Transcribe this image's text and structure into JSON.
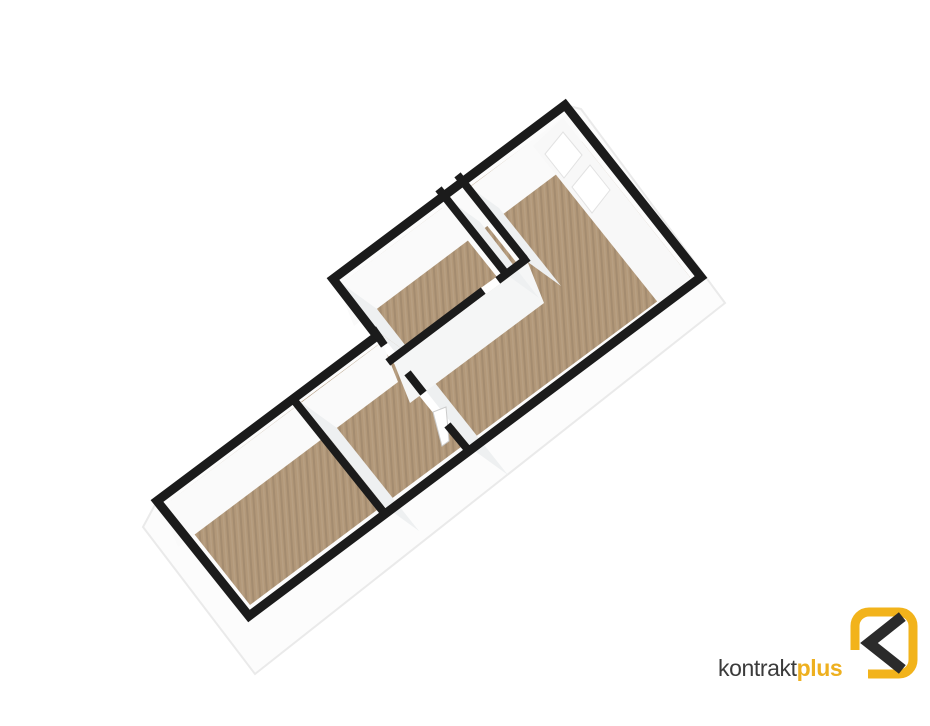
{
  "canvas": {
    "width": 930,
    "height": 726,
    "background": "#ffffff"
  },
  "palette": {
    "wall_line": "#1b1b1b",
    "skirt_fill": "#fcfcfc",
    "skirt_edge": "#eaeaea",
    "face_bright": "#fafafa",
    "face_side": "#eef0f1",
    "face_strip": "#f5f6f6",
    "face_east": "#f8f8f8",
    "white": "#ffffff"
  },
  "floor_pattern": {
    "base": "#b29879",
    "dark": "rgba(0,0,0,0.08)",
    "light": "rgba(255,255,255,0.07)",
    "tile": 7,
    "angle": -4
  },
  "scene": {
    "layers": [
      {
        "name": "slab-silhouette",
        "type": "polygon",
        "points": [
          [
            581,
            109
          ],
          [
            725,
            303
          ],
          [
            255,
            674
          ],
          [
            143,
            527
          ],
          [
            157,
            501
          ],
          [
            377,
            336
          ],
          [
            333,
            279
          ],
          [
            565,
            105
          ]
        ],
        "fill": "#fcfcfc",
        "stroke": "#eaeaea",
        "width": 2
      },
      {
        "name": "floor-bedroom-1",
        "type": "polygon",
        "points": [
          [
            250,
            605
          ],
          [
            377,
            510
          ],
          [
            295,
            407
          ],
          [
            169,
            502
          ]
        ],
        "fill": "planks"
      },
      {
        "name": "floor-bedroom-2",
        "type": "polygon",
        "points": [
          [
            383,
            505
          ],
          [
            461,
            447
          ],
          [
            379,
            344
          ],
          [
            301,
            402
          ]
        ],
        "fill": "planks"
      },
      {
        "name": "floor-kitchen",
        "type": "polygon",
        "points": [
          [
            395,
            353
          ],
          [
            497,
            277
          ],
          [
            442,
            208
          ],
          [
            341,
            284
          ]
        ],
        "fill": "planks"
      },
      {
        "name": "floor-hallway",
        "type": "polygon",
        "points": [
          [
            503,
            272
          ],
          [
            516,
            262
          ],
          [
            462,
            194
          ],
          [
            449,
            204
          ]
        ],
        "fill": "planks"
      },
      {
        "name": "floor-living-room",
        "type": "polygon",
        "points": [
          [
            467,
            443
          ],
          [
            690,
            277
          ],
          [
            563,
            118
          ],
          [
            468,
            188
          ],
          [
            528,
            263
          ],
          [
            400,
            359
          ]
        ],
        "fill": "planks"
      },
      {
        "name": "door-threshold-1",
        "type": "polygon",
        "points": [
          [
            447,
            430
          ],
          [
            454,
            425
          ],
          [
            424,
            388
          ],
          [
            417,
            393
          ]
        ],
        "fill": "#ffffff"
      },
      {
        "name": "door-threshold-2",
        "type": "polygon",
        "points": [
          [
            406,
            379
          ],
          [
            413,
            374
          ],
          [
            385,
            339
          ],
          [
            379,
            344
          ]
        ],
        "fill": "#ffffff"
      },
      {
        "name": "door-threshold-3",
        "type": "polygon",
        "points": [
          [
            483,
            296
          ],
          [
            504,
            281
          ],
          [
            499,
            275
          ],
          [
            478,
            290
          ]
        ],
        "fill": "#ffffff"
      },
      {
        "name": "face-bedrooms-north-wall",
        "type": "polygon",
        "points": [
          [
            162,
            507
          ],
          [
            382,
            342
          ],
          [
            398,
            382
          ],
          [
            178,
            547
          ]
        ],
        "fill": "#fafafa"
      },
      {
        "name": "face-living-north-wall",
        "type": "polygon",
        "points": [
          [
            338,
            286
          ],
          [
            570,
            112
          ],
          [
            586,
            152
          ],
          [
            354,
            326
          ]
        ],
        "fill": "#fafafa"
      },
      {
        "name": "face-kitchen-west-wall",
        "type": "polygon",
        "points": [
          [
            341,
            283
          ],
          [
            380,
            333
          ],
          [
            416,
            359
          ],
          [
            377,
            309
          ]
        ],
        "fill": "#eef0f1"
      },
      {
        "name": "face-bedroom-divider-wall",
        "type": "polygon",
        "points": [
          [
            301,
            402
          ],
          [
            383,
            505
          ],
          [
            419,
            531
          ],
          [
            337,
            428
          ]
        ],
        "fill": "#eef0f1"
      },
      {
        "name": "face-partition-east-wall",
        "type": "polygon",
        "points": [
          [
            380,
            333
          ],
          [
            472,
            449
          ],
          [
            508,
            475
          ],
          [
            416,
            359
          ]
        ],
        "fill": "#eef0f1"
      },
      {
        "name": "face-strip-north-wall",
        "type": "polygon",
        "points": [
          [
            394,
            363
          ],
          [
            528,
            263
          ],
          [
            544,
            303
          ],
          [
            410,
            403
          ]
        ],
        "fill": "#f5f6f6"
      },
      {
        "name": "face-hallway-west-wall",
        "type": "polygon",
        "points": [
          [
            444,
            196
          ],
          [
            503,
            272
          ],
          [
            539,
            298
          ],
          [
            480,
            222
          ]
        ],
        "fill": "#eef0f1"
      },
      {
        "name": "face-hallway-east-wall",
        "type": "polygon",
        "points": [
          [
            463,
            182
          ],
          [
            525,
            260
          ],
          [
            561,
            286
          ],
          [
            499,
            208
          ]
        ],
        "fill": "#eef0f1"
      },
      {
        "name": "face-east-wall",
        "type": "polygon",
        "points": [
          [
            690,
            277
          ],
          [
            563,
            118
          ],
          [
            533,
            146
          ],
          [
            660,
            305
          ]
        ],
        "fill": "#f8f8f8"
      },
      {
        "name": "window-1",
        "type": "polygon",
        "points": [
          [
            610,
            190
          ],
          [
            590,
            165
          ],
          [
            572,
            187
          ],
          [
            592,
            213
          ]
        ],
        "fill": "#ffffff",
        "stroke": "#e2e2e2",
        "width": 1
      },
      {
        "name": "window-2",
        "type": "polygon",
        "points": [
          [
            582,
            155
          ],
          [
            563,
            132
          ],
          [
            545,
            154
          ],
          [
            564,
            178
          ]
        ],
        "fill": "#ffffff",
        "stroke": "#e2e2e2",
        "width": 1
      },
      {
        "name": "door-leaf",
        "type": "polygon",
        "points": [
          [
            446,
            407
          ],
          [
            433,
            412
          ],
          [
            442,
            446
          ],
          [
            449,
            441
          ]
        ],
        "fill": "#ffffff",
        "stroke": "#cccccc",
        "width": 1
      },
      {
        "name": "wall-top-outer-outline",
        "type": "polygon",
        "points": [
          [
            249,
            616
          ],
          [
            701,
            277
          ],
          [
            565,
            105
          ],
          [
            333,
            279
          ],
          [
            377,
            336
          ],
          [
            157,
            501
          ]
        ],
        "fill": "none",
        "stroke": "#1b1b1b",
        "width": 9
      },
      {
        "name": "wall-top-bedroom-divider",
        "type": "polyline",
        "points": [
          [
            385,
            514
          ],
          [
            293,
            399
          ]
        ],
        "stroke": "#1b1b1b",
        "width": 8
      },
      {
        "name": "wall-top-partition-a",
        "type": "polyline",
        "points": [
          [
            469,
            451
          ],
          [
            450,
            428
          ]
        ],
        "stroke": "#1b1b1b",
        "width": 8
      },
      {
        "name": "wall-top-partition-b",
        "type": "polyline",
        "points": [
          [
            421,
            390
          ],
          [
            410,
            376
          ]
        ],
        "stroke": "#1b1b1b",
        "width": 8
      },
      {
        "name": "wall-top-partition-c",
        "type": "polyline",
        "points": [
          [
            382,
            342
          ],
          [
            375,
            332
          ]
        ],
        "stroke": "#1b1b1b",
        "width": 8
      },
      {
        "name": "wall-top-kitchen-south-a",
        "type": "polyline",
        "points": [
          [
            391,
            360
          ],
          [
            480,
            293
          ]
        ],
        "stroke": "#1b1b1b",
        "width": 8
      },
      {
        "name": "wall-top-kitchen-south-b",
        "type": "polyline",
        "points": [
          [
            501,
            278
          ],
          [
            525,
            260
          ]
        ],
        "stroke": "#1b1b1b",
        "width": 8
      },
      {
        "name": "wall-top-hallway-west",
        "type": "polyline",
        "points": [
          [
            503,
            270
          ],
          [
            441,
            192
          ]
        ],
        "stroke": "#1b1b1b",
        "width": 8
      },
      {
        "name": "wall-top-hallway-east",
        "type": "polyline",
        "points": [
          [
            522,
            256
          ],
          [
            460,
            178
          ]
        ],
        "stroke": "#1b1b1b",
        "width": 8
      },
      {
        "name": "logo-mark-ring",
        "type": "rect",
        "x": 855,
        "y": 612,
        "w": 58,
        "h": 62,
        "rx": 14,
        "fill": "none",
        "stroke": "#f2b31b",
        "width": 9
      },
      {
        "name": "logo-mark-chevron",
        "type": "polyline",
        "points": [
          [
            898,
            620
          ],
          [
            869,
            643
          ],
          [
            898,
            666
          ]
        ],
        "stroke": "#2b2b2b",
        "width": 11
      },
      {
        "name": "logo-text-backplate",
        "type": "polygon",
        "points": [
          [
            716,
            650
          ],
          [
            868,
            650
          ],
          [
            868,
            684
          ],
          [
            716,
            684
          ]
        ],
        "fill": "#ffffff"
      }
    ]
  },
  "logo": {
    "text_primary": "kontrakt",
    "text_accent": "plus",
    "primary_color": "#3b3b3b",
    "accent_color": "#eeb01f"
  }
}
